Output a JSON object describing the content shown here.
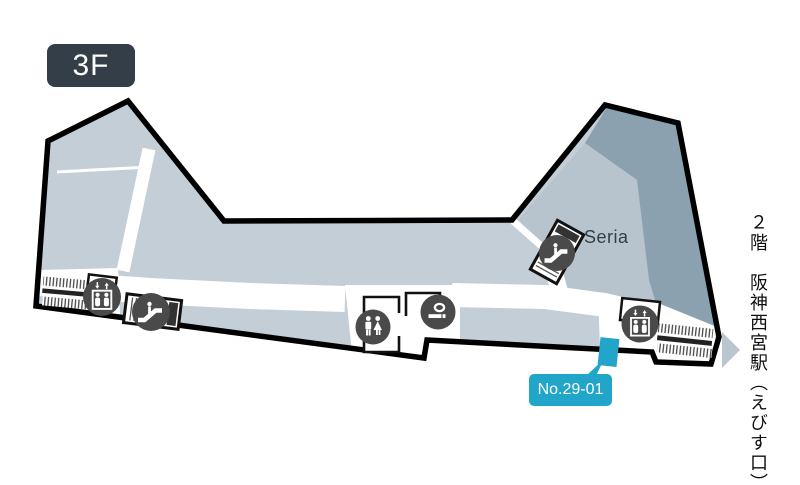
{
  "floor_badge": {
    "label": "3F"
  },
  "labels": {
    "store": "Seria",
    "booth": "No.29-01",
    "exit_vertical": "２階　阪神西宮駅（えびす口）"
  },
  "map_icons": [
    {
      "name": "elevator-left-icon",
      "meaning": "elevator"
    },
    {
      "name": "escalator-left-icon",
      "meaning": "escalator"
    },
    {
      "name": "restroom-icon",
      "meaning": "toilets"
    },
    {
      "name": "smoking-area-icon",
      "meaning": "smoking area"
    },
    {
      "name": "escalator-right-icon",
      "meaning": "escalator"
    },
    {
      "name": "elevator-right-icon",
      "meaning": "elevator"
    },
    {
      "name": "stairs-left-icon",
      "meaning": "stairs"
    },
    {
      "name": "stairs-right-icon",
      "meaning": "stairs"
    },
    {
      "name": "exit-arrow-icon",
      "meaning": "direction to station exit"
    }
  ],
  "colors": {
    "outline": "#000000",
    "floor_light": "#c3ced7",
    "floor_medium": "#b7c3cd",
    "floor_dark": "#8ba1b0",
    "icon_circle": "#4a4a4a",
    "badge_bg": "#333e48",
    "highlight": "#21a5c9"
  }
}
